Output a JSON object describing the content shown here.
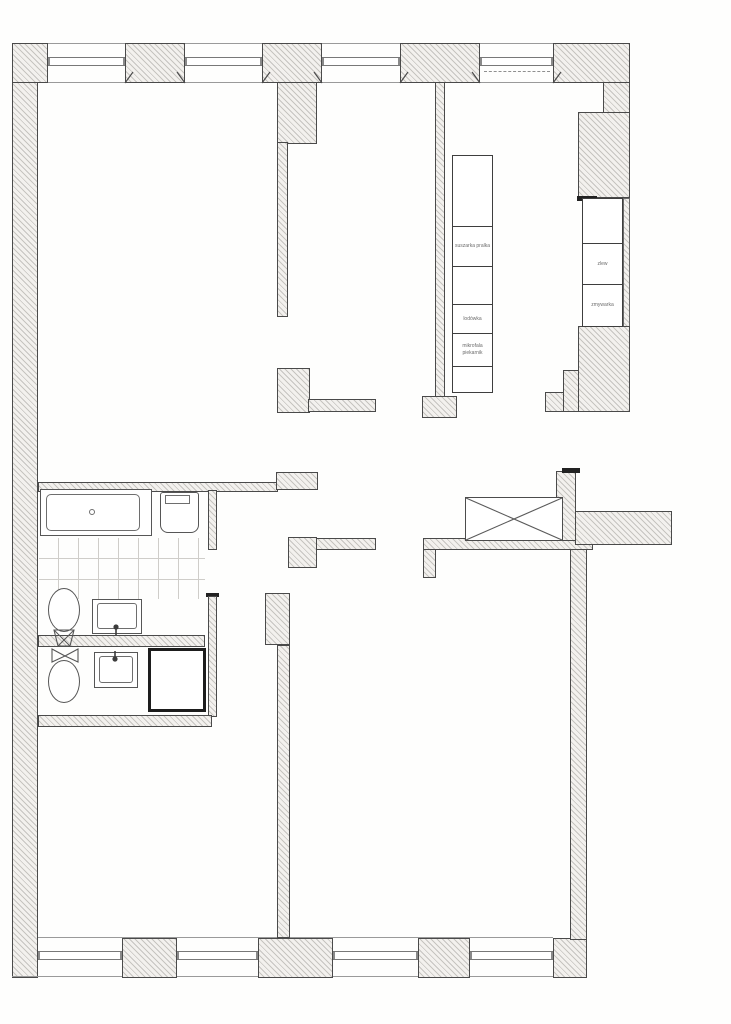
{
  "drawing": {
    "kind": "apartment floor plan, scanned architectural drawing",
    "rooms_visible_count": 7,
    "colors": {
      "paper": "#fefefd",
      "wall_outline": "#4a4a4a",
      "heavy_outline": "#1d1d1d",
      "hatch_stripe": "#c6c4c0",
      "hatch_fill": "#f3f1ee",
      "fixture_line": "#565656",
      "label_text": "#6c6c6c"
    }
  },
  "appliances": {
    "left_column": [
      "",
      "suszarka pralka",
      "",
      "lodówka",
      "mikrofala piekarnik",
      ""
    ],
    "right_column": [
      "",
      "zlew",
      "zmywarka"
    ]
  }
}
